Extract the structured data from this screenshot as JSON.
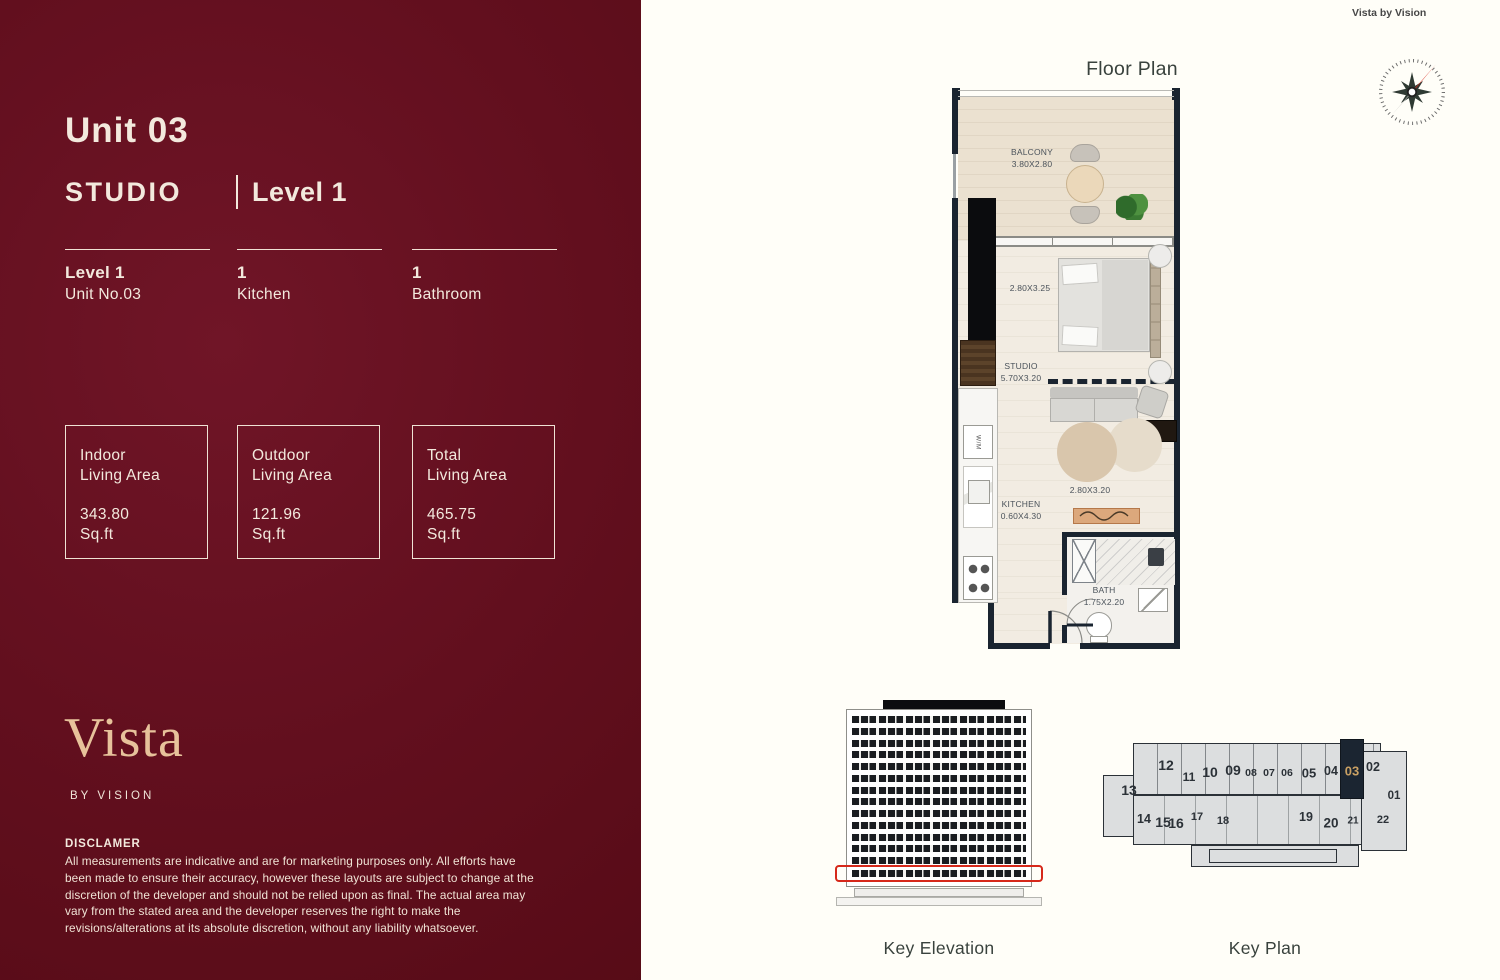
{
  "brand": {
    "watermark": "Vista by Vision",
    "logo": "Vista",
    "byline": "BY VISION"
  },
  "unit": {
    "title": "Unit 03",
    "type": "STUDIO",
    "level": "Level 1",
    "specs": [
      {
        "value": "Level 1",
        "label": "Unit No.03"
      },
      {
        "value": "1",
        "label": "Kitchen"
      },
      {
        "value": "1",
        "label": "Bathroom"
      }
    ],
    "areas": [
      {
        "label_line1": "Indoor",
        "label_line2": "Living Area",
        "value": "343.80",
        "unit": "Sq.ft"
      },
      {
        "label_line1": "Outdoor",
        "label_line2": "Living Area",
        "value": "121.96",
        "unit": "Sq.ft"
      },
      {
        "label_line1": "Total",
        "label_line2": "Living Area",
        "value": "465.75",
        "unit": "Sq.ft"
      }
    ]
  },
  "disclaimer": {
    "heading": "DISCLAMER",
    "body": "All measurements are indicative and are for marketing purposes only. All efforts have been made to ensure their accuracy, however these layouts are subject to change at the discretion of the developer and should not be relied upon as final. The actual area may vary from the stated area and the developer reserves the right to make the revisions/alterations at its absolute discretion, without any liability whatsoever."
  },
  "floor_plan": {
    "title": "Floor Plan",
    "labels": {
      "balcony": "BALCONY",
      "balcony_dim": "3.80X2.80",
      "bed_dim": "2.80X3.25",
      "studio": "STUDIO",
      "studio_dim": "5.70X3.20",
      "living_dim": "2.80X3.20",
      "kitchen": "KITCHEN",
      "kitchen_dim": "0.60X4.30",
      "bath": "BATH",
      "bath_dim": "1.75X2.20",
      "washer": "W/M"
    }
  },
  "key_elevation": {
    "caption": "Key Elevation"
  },
  "key_plan": {
    "caption": "Key Plan",
    "highlighted": "03",
    "top_units": [
      "12",
      "11",
      "10",
      "09",
      "08",
      "07",
      "06",
      "05",
      "04",
      "03",
      "02"
    ],
    "side_unit": "01",
    "bottom_units": [
      "13",
      "14",
      "15",
      "16",
      "17",
      "18",
      "19",
      "20",
      "21",
      "22"
    ]
  },
  "colors": {
    "panel_maroon": "#5E0E1B",
    "cream": "#F3E9DD",
    "gold": "#E7C29B",
    "wall_navy": "#1A2430",
    "highlight_red": "#D6281A",
    "keyplan_gold": "#C9A063"
  }
}
